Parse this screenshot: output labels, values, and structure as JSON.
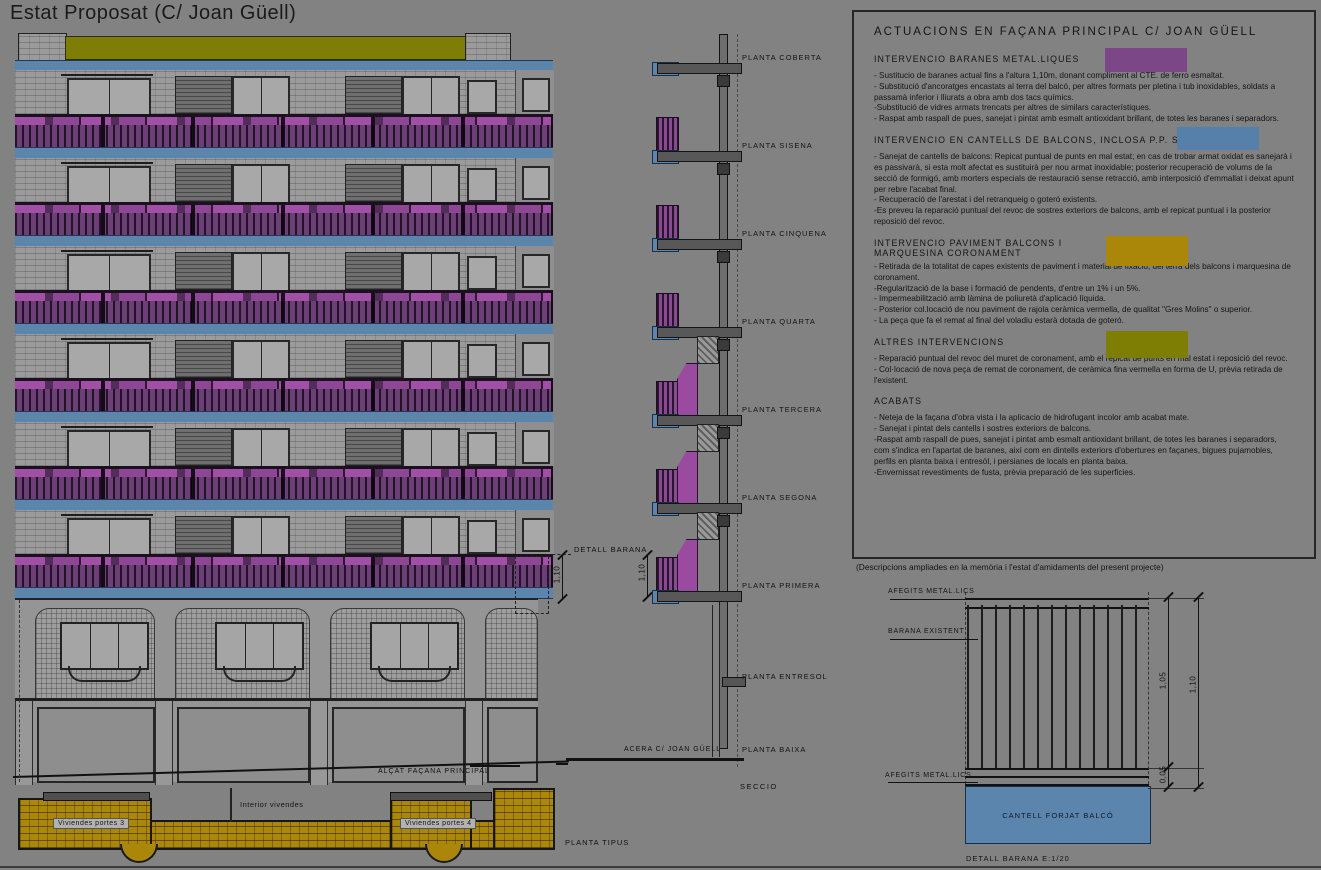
{
  "page": {
    "title": "Estat Proposat (C/ Joan Güell)"
  },
  "colors": {
    "background": "#828282",
    "ink": "#141414",
    "purple": "#7c4787",
    "purple_bright": "#a24fa6",
    "blue": "#567fa9",
    "mustard": "#ab8709",
    "olive": "#7e7e04",
    "wall_gray": "#9b9b9b"
  },
  "facade": {
    "caption": "ALÇAT FAÇANA PRINCIPAL",
    "detail_callout": "DETALL BARANA",
    "dim_height": "1,10"
  },
  "section": {
    "caption": "SECCIO",
    "street_label": "ACERA C/ JOAN GÜELL",
    "dim_height": "1,10",
    "floors": [
      "PLANTA COBERTA",
      "PLANTA SISENA",
      "PLANTA CINQUENA",
      "PLANTA QUARTA",
      "PLANTA TERCERA",
      "PLANTA SEGONA",
      "PLANTA PRIMERA",
      "PLANTA ENTRESOL",
      "PLANTA BAIXA"
    ]
  },
  "plan": {
    "caption": "PLANTA TIPUS",
    "left_label": "Viviendes portes 3",
    "right_label": "Viviendes portes 4",
    "interior_label": "Interior vivendes"
  },
  "legend": {
    "title": "ACTUACIONS EN FAÇANA PRINCIPAL C/ JOAN GÜELL",
    "sections": [
      {
        "heading": "INTERVENCIO BARANES METAL.LIQUES",
        "swatch": "purple",
        "body": "- Sustitucio de baranes actual fins a l'altura 1,10m, donant compliment al CTE. de ferro esmaltat.\n- Substitució d'ancoratges encastats al terra del balcó, per altres formats per pletina i tub inoxidables, soldats a passamà inferior i lliurats a obra amb dos tacs químics.\n-Substitució de vidres armats trencats per altres de similars característiques.\n- Raspat amb raspall de pues, sanejat i pintat amb esmalt antioxidant brillant, de totes les baranes i separadors."
      },
      {
        "heading": "INTERVENCIO EN CANTELLS DE BALCONS, INCLOSA P.P. SOSTRES",
        "swatch": "blue",
        "body": "- Sanejat de cantells de balcons: Repicat puntual de punts en mal estat; en cas de trobar armat oxidat es sanejarà i es passivarà, si esta molt afectat es sustituirà per nou armat inoxidable; posterior recuperació de volums de la secció de formigó, amb morters especials de restauració sense retracció, amb interposició d'emmallat i deixat apunt per rebre l'acabat final.\n- Recuperació de l'arestat i del retranqueig o goteró existents.\n-Es preveu la reparació puntual del revoc de sostres exteriors de balcons, amb el repicat puntual i la posterior reposició del revoc."
      },
      {
        "heading": "INTERVENCIO PAVIMENT BALCONS I\nMARQUESINA CORONAMENT",
        "swatch": "mustard",
        "body": "- Retirada de la totalitat de capes existents de paviment i material de fixació, del terra dels balcons i marquesina de coronament.\n-Regularització de la base i formació de pendents, d'entre un 1% i un 5%.\n- Impermeabilització amb làmina de poliuretà d'aplicació líquida.\n- Posterior col.locació de nou paviment de rajola ceràmica vermella, de qualitat \"Gres Molins\" o superior.\n- La peça que fa el remat al final del voladiu estarà dotada de goteró."
      },
      {
        "heading": "ALTRES INTERVENCIONS",
        "swatch": "olive",
        "body": "- Reparació puntual del revoc del muret de coronament, amb el repicat de punts en mal estat i reposició del revoc.\n- Col·locació de nova peça de remat de coronament, de ceràmica fina vermella en forma de U, prèvia retirada de l'existent."
      },
      {
        "heading": "ACABATS",
        "swatch": null,
        "body": "- Neteja de la façana d'obra vista i la aplicacio de hidrofugant incolor amb acabat mate.\n- Sanejat i pintat dels cantells i sostres exteriors de balcons.\n-Raspat amb raspall de pues, sanejat i pintat amb esmalt antioxidant brillant, de totes les baranes i separadors, com s'indica en l'apartat de baranes, així com en dintells exteriors d'obertures en façanes, bigues pujamobles, perfils en planta baixa i entresòl, i persianes de locals en planta baixa.\n-Envernissat revestiments de fusta, prèvia preparació de les superficies."
      }
    ],
    "footnote": "(Descripcions ampliades en la memòria i l'estat d'amidaments del present projecte)"
  },
  "detail": {
    "caption": "DETALL BARANA E:1/20",
    "label_afegits_top": "AFEGITS METAL.LICS",
    "label_barana": "BARANA EXISTENT",
    "label_afegits_bottom": "AFEGITS METAL.LICS",
    "label_cantell": "CANTELL FORJAT BALCÓ",
    "dim_105": "1,05",
    "dim_110": "1,10",
    "dim_005": "0,05"
  }
}
